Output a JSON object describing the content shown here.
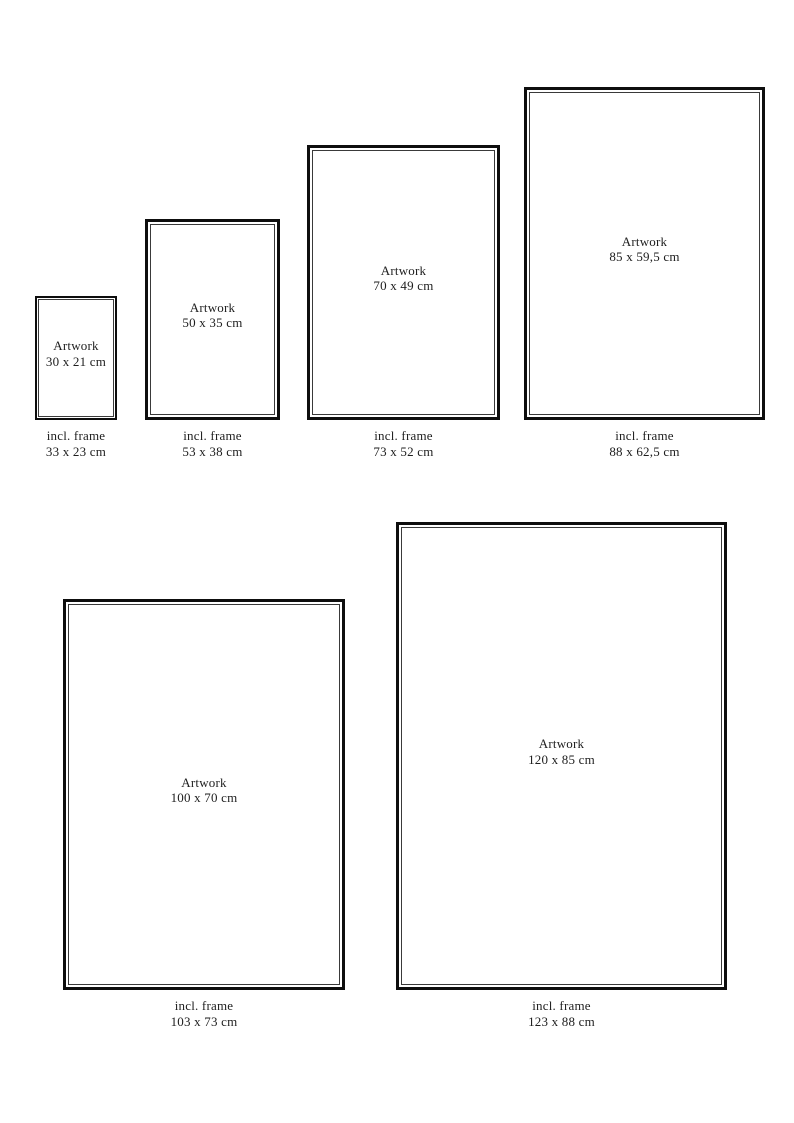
{
  "page": {
    "background": "#ffffff",
    "text_color": "#1e1e1e",
    "frame_border_color": "#0e0e0e",
    "inner_line_color": "#3a3a3a"
  },
  "frames": [
    {
      "artwork_label": "Artwork",
      "artwork_size": "30 x 21 cm",
      "incl_label": "incl. frame",
      "incl_size": "33 x 23 cm",
      "left": 35,
      "top": 296,
      "width": 82,
      "height": 124,
      "border_px": 2,
      "gap_px": 1
    },
    {
      "artwork_label": "Artwork",
      "artwork_size": "50 x 35 cm",
      "incl_label": "incl. frame",
      "incl_size": "53 x 38 cm",
      "left": 145,
      "top": 219,
      "width": 135,
      "height": 201,
      "border_px": 3,
      "gap_px": 2
    },
    {
      "artwork_label": "Artwork",
      "artwork_size": "70 x 49 cm",
      "incl_label": "incl. frame",
      "incl_size": "73 x 52 cm",
      "left": 307,
      "top": 145,
      "width": 193,
      "height": 275,
      "border_px": 3,
      "gap_px": 2
    },
    {
      "artwork_label": "Artwork",
      "artwork_size": "85 x 59,5 cm",
      "incl_label": "incl. frame",
      "incl_size": "88 x 62,5 cm",
      "left": 524,
      "top": 87,
      "width": 241,
      "height": 333,
      "border_px": 3,
      "gap_px": 2
    },
    {
      "artwork_label": "Artwork",
      "artwork_size": "100 x 70 cm",
      "incl_label": "incl. frame",
      "incl_size": "103 x 73 cm",
      "left": 63,
      "top": 599,
      "width": 282,
      "height": 391,
      "border_px": 3,
      "gap_px": 2
    },
    {
      "artwork_label": "Artwork",
      "artwork_size": "120 x 85 cm",
      "incl_label": "incl. frame",
      "incl_size": "123 x 88 cm",
      "left": 396,
      "top": 522,
      "width": 331,
      "height": 468,
      "border_px": 3,
      "gap_px": 2
    }
  ]
}
